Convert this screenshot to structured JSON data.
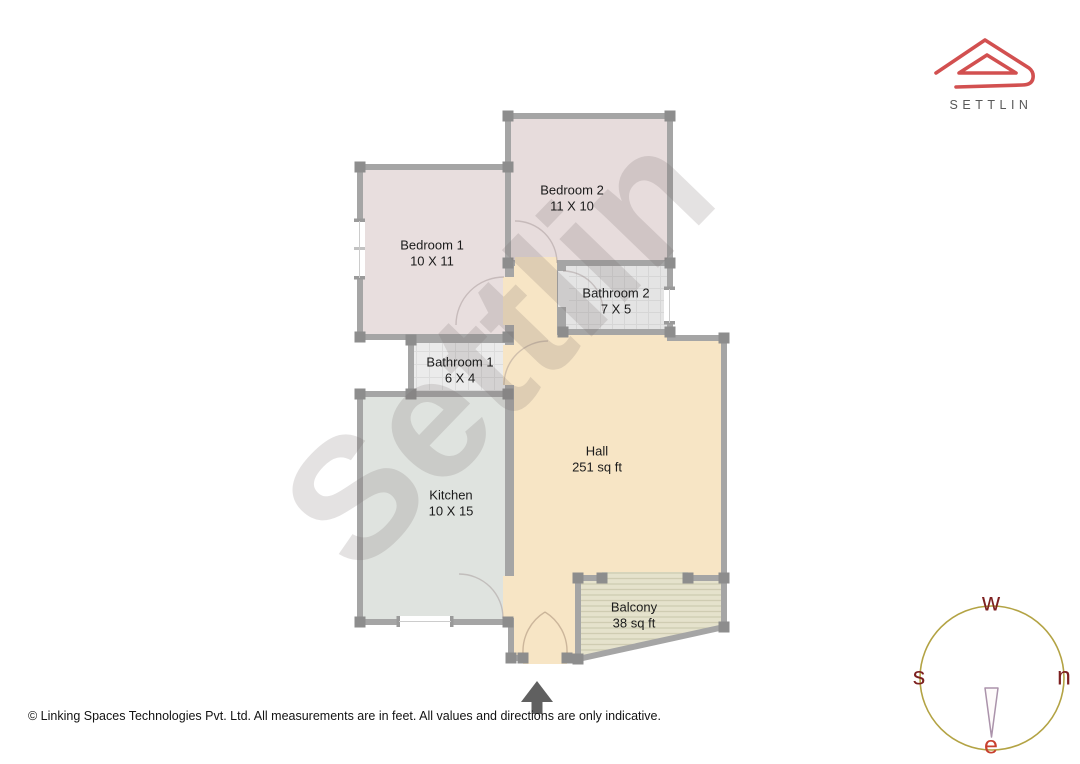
{
  "page": {
    "background": "#ffffff",
    "copyright": "© Linking Spaces Technologies Pvt. Ltd. All measurements are in feet. All values and directions are only indicative."
  },
  "brand": {
    "name": "SETTLIN",
    "logo_color": "#d25050",
    "text_color": "#585858"
  },
  "watermark": {
    "text": "Settlin"
  },
  "plan": {
    "units": "feet",
    "rooms": [
      {
        "id": "bedroom1",
        "name": "Bedroom 1",
        "dims": "10 X 11"
      },
      {
        "id": "bedroom2",
        "name": "Bedroom 2",
        "dims": "11 X 10"
      },
      {
        "id": "bathroom2",
        "name": "Bathroom 2",
        "dims": "7 X 5"
      },
      {
        "id": "bathroom1",
        "name": "Bathroom 1",
        "dims": "6 X 4"
      },
      {
        "id": "kitchen",
        "name": "Kitchen",
        "dims": "10 X 15"
      },
      {
        "id": "hall",
        "name": "Hall",
        "dims": "251 sq ft"
      },
      {
        "id": "balcony",
        "name": "Balcony",
        "dims": "38 sq ft"
      }
    ],
    "colors": {
      "bedroom": "#e7dcdc",
      "bathroom": "#e6e6e6",
      "kitchen": "#dfe3df",
      "hall": "#f7e5c5",
      "balcony": "#e4e1ca",
      "wall": "#a5a5a5"
    }
  },
  "compass": {
    "top": "w",
    "right": "n",
    "left": "s",
    "bottom": "e",
    "needle_direction": "down"
  },
  "north_arrow": {
    "direction": "up"
  }
}
